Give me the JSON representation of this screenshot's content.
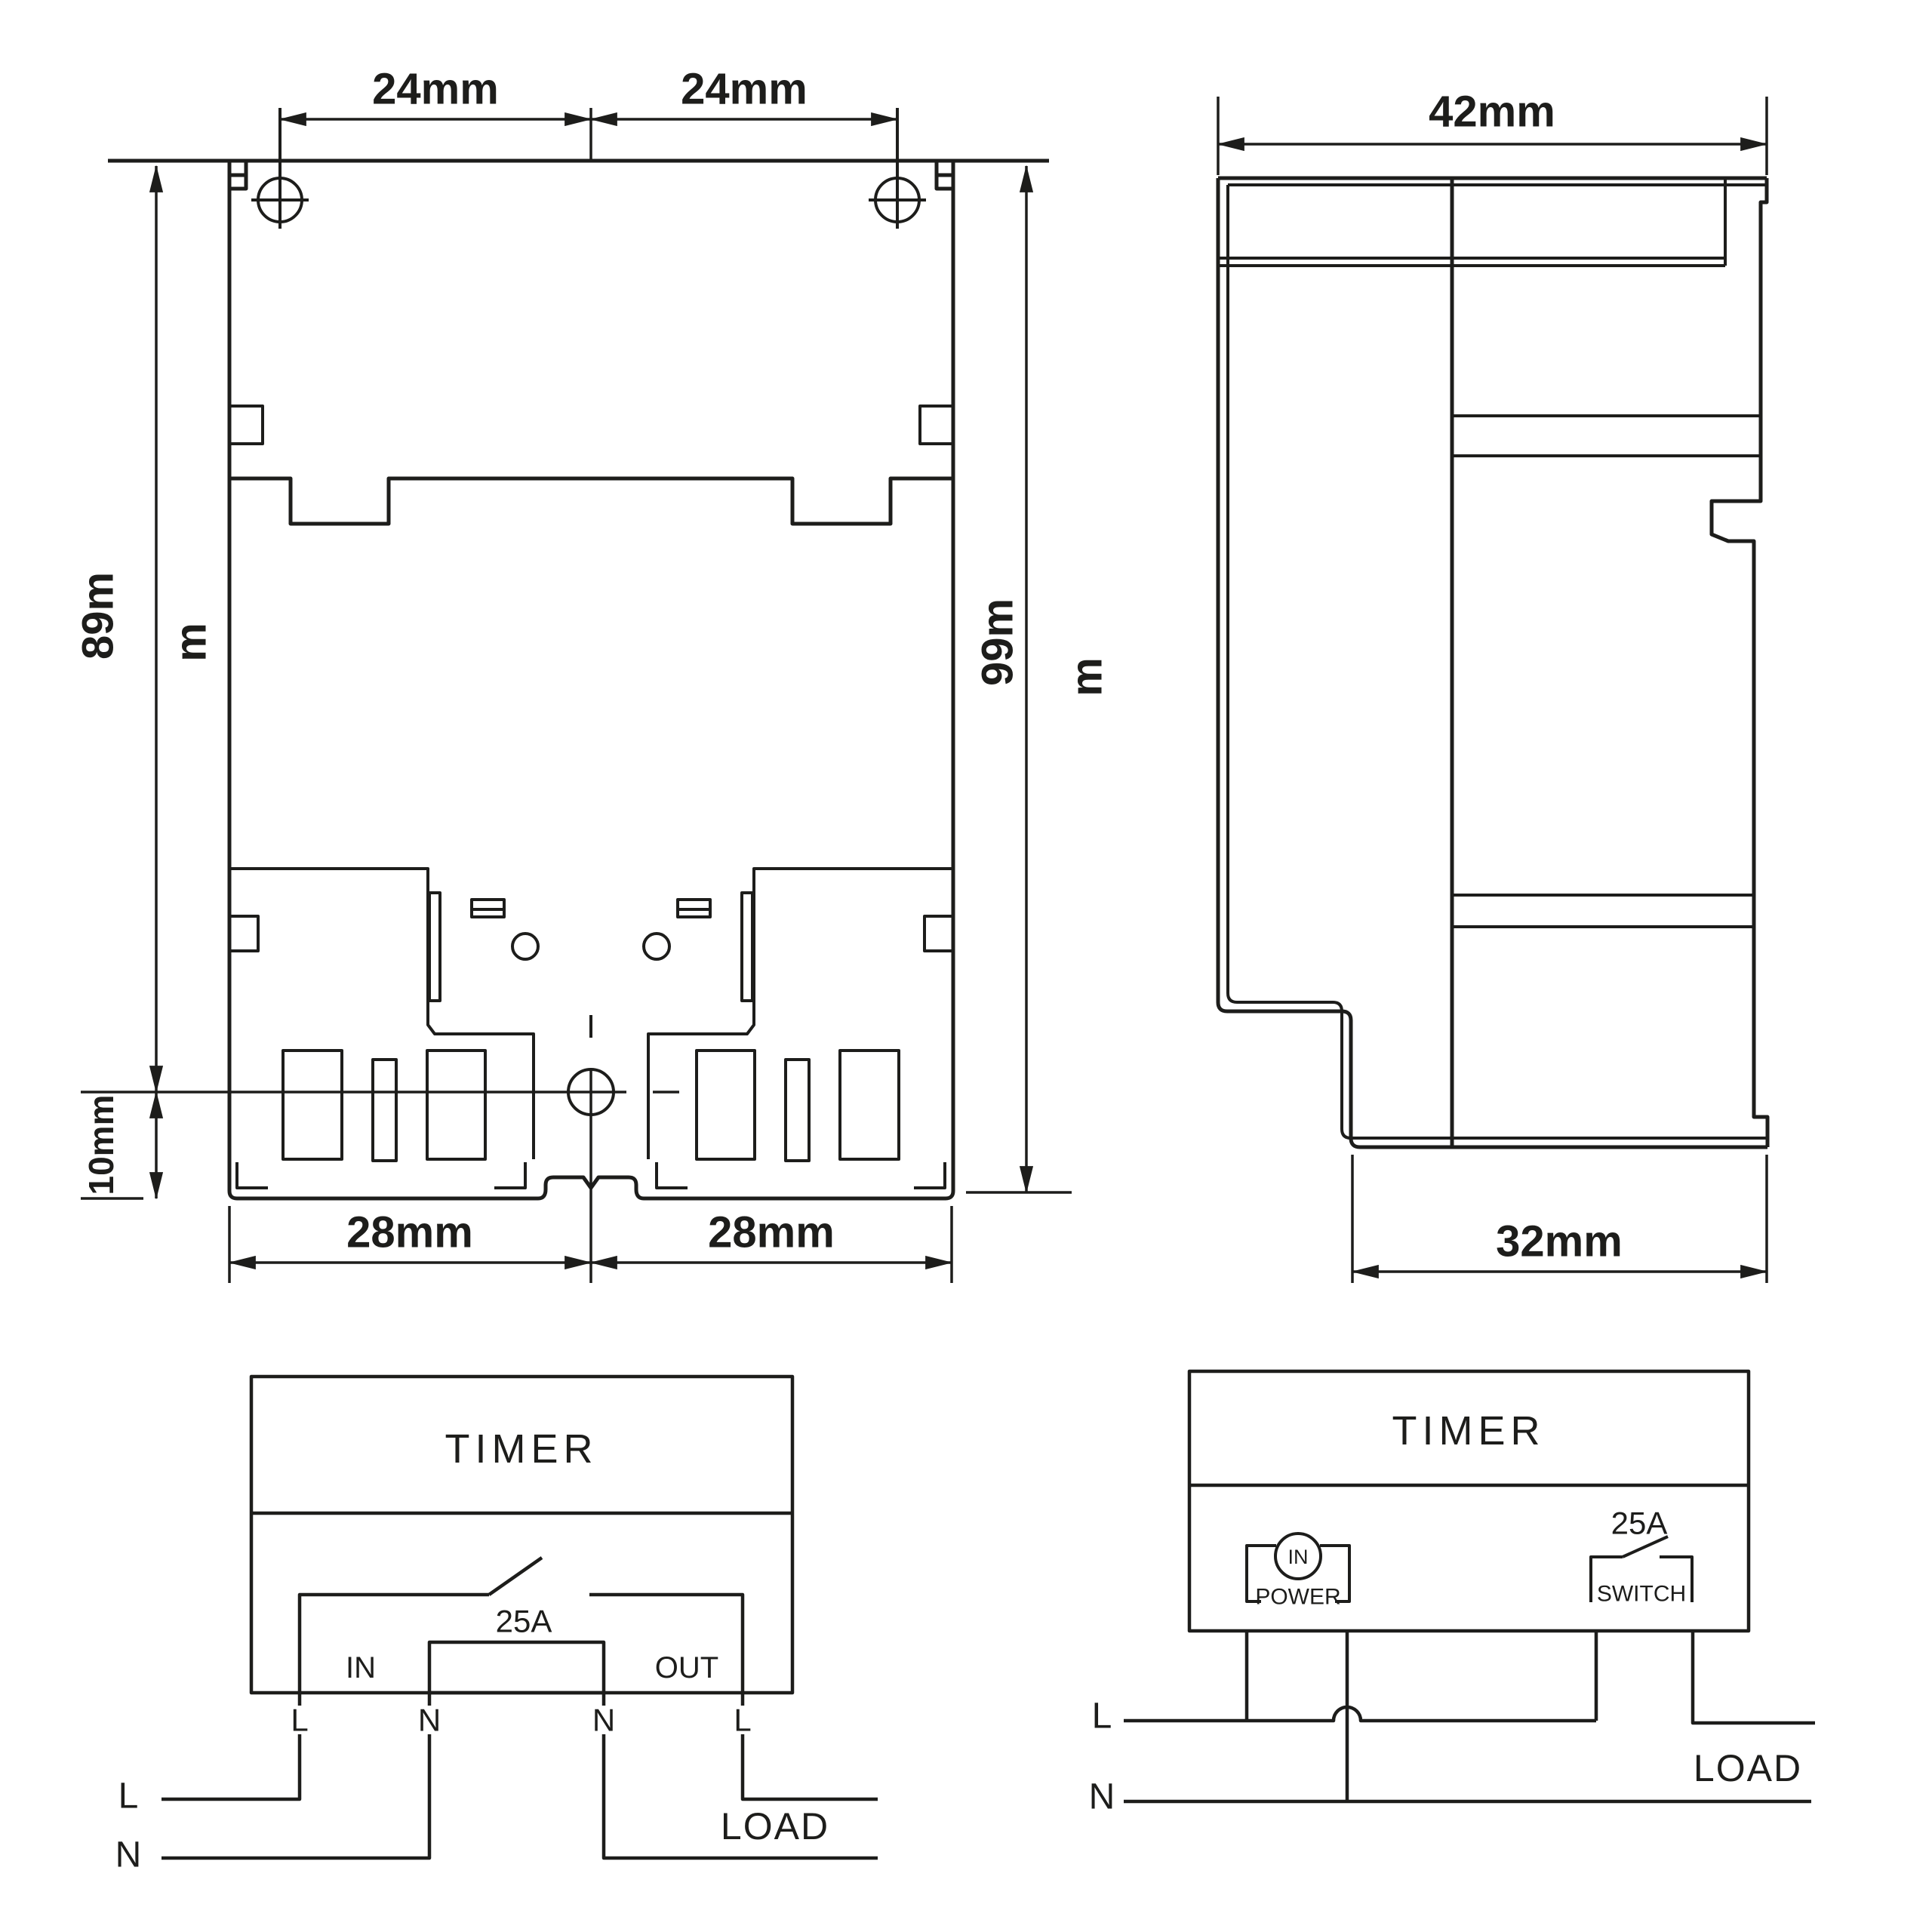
{
  "colors": {
    "line": "#1d1d1b",
    "background": "#ffffff"
  },
  "front_view": {
    "dim_hole_spacing_left": "24mm",
    "dim_hole_spacing_right": "24mm",
    "dim_height_main": "89m",
    "dim_height_main_wrap": "m",
    "dim_height_total": "99m",
    "dim_height_total_wrap": "m",
    "dim_bottom_offset": "10mm",
    "dim_width_left": "28mm",
    "dim_width_right": "28mm"
  },
  "side_view": {
    "dim_depth_top": "42mm",
    "dim_depth_bottom": "32mm"
  },
  "wiring_inline": {
    "title": "TIMER",
    "rating": "25A",
    "label_in": "IN",
    "label_out": "OUT",
    "terminals": [
      "L",
      "N",
      "N",
      "L"
    ],
    "supply_live": "L",
    "supply_neutral": "N",
    "load_label": "LOAD"
  },
  "wiring_switched": {
    "title": "TIMER",
    "rating": "25A",
    "power_core": "IN",
    "power_label": "POWER",
    "switch_label": "SWITCH",
    "supply_live": "L",
    "supply_neutral": "N",
    "load_label": "LOAD"
  }
}
